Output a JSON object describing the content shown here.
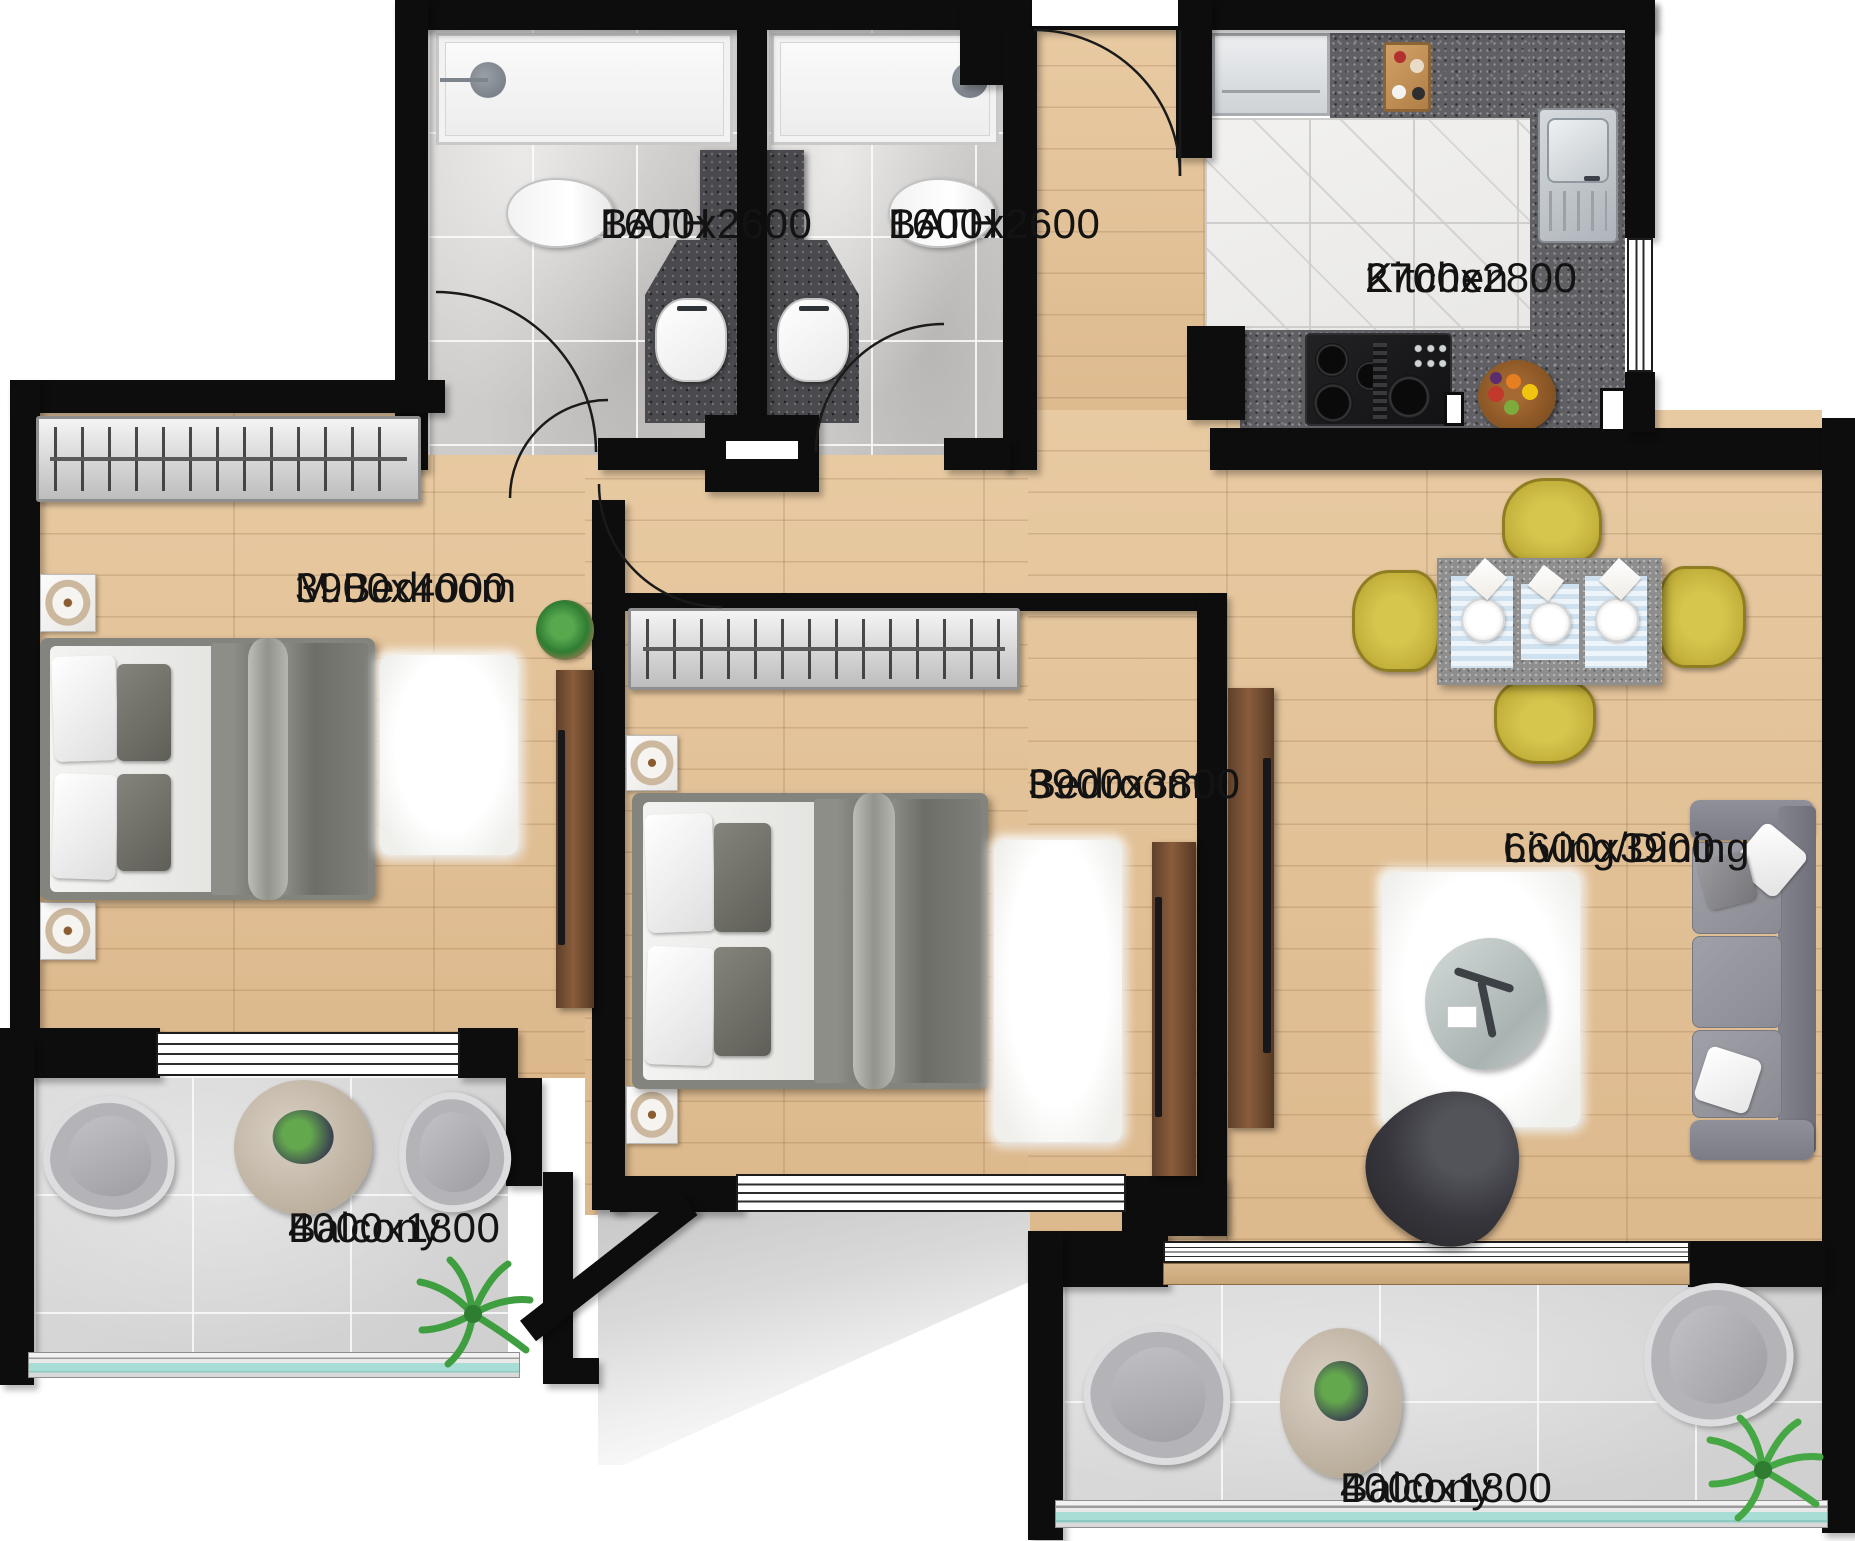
{
  "plan_title": "Apartment floor plan - 2 bedroom unit",
  "rooms": {
    "bath1": {
      "name": "BATH",
      "dims": "1600x2600"
    },
    "bath2": {
      "name": "BATH",
      "dims": "1600x2600"
    },
    "kitchen": {
      "name": "Kitchen",
      "dims": "2700x2800"
    },
    "master_bedroom": {
      "name": "M.Bedroom",
      "dims": "3900x4000"
    },
    "bedroom": {
      "name": "Bedroom",
      "dims": "3900x3800"
    },
    "living_dining": {
      "name": "Living/Dining",
      "dims": "6600x3900"
    },
    "balcony_left": {
      "name": "Balcony",
      "dims": "4000x1800"
    },
    "balcony_right": {
      "name": "Balcony",
      "dims": "4000x1800"
    }
  },
  "colors": {
    "wall": "#0d0d0e",
    "wood_floor": "#e2c099",
    "bath_tile": "#d2d0ce",
    "kitchen_marble": "#efeeec",
    "granite_counter": "#5f5f64",
    "balcony_tile": "#d8d8d8",
    "dining_chair_yellow": "#c4b23c",
    "sofa_gray": "#90909a",
    "railing_glass": "#a8ddd6",
    "label_text": "#131313"
  }
}
